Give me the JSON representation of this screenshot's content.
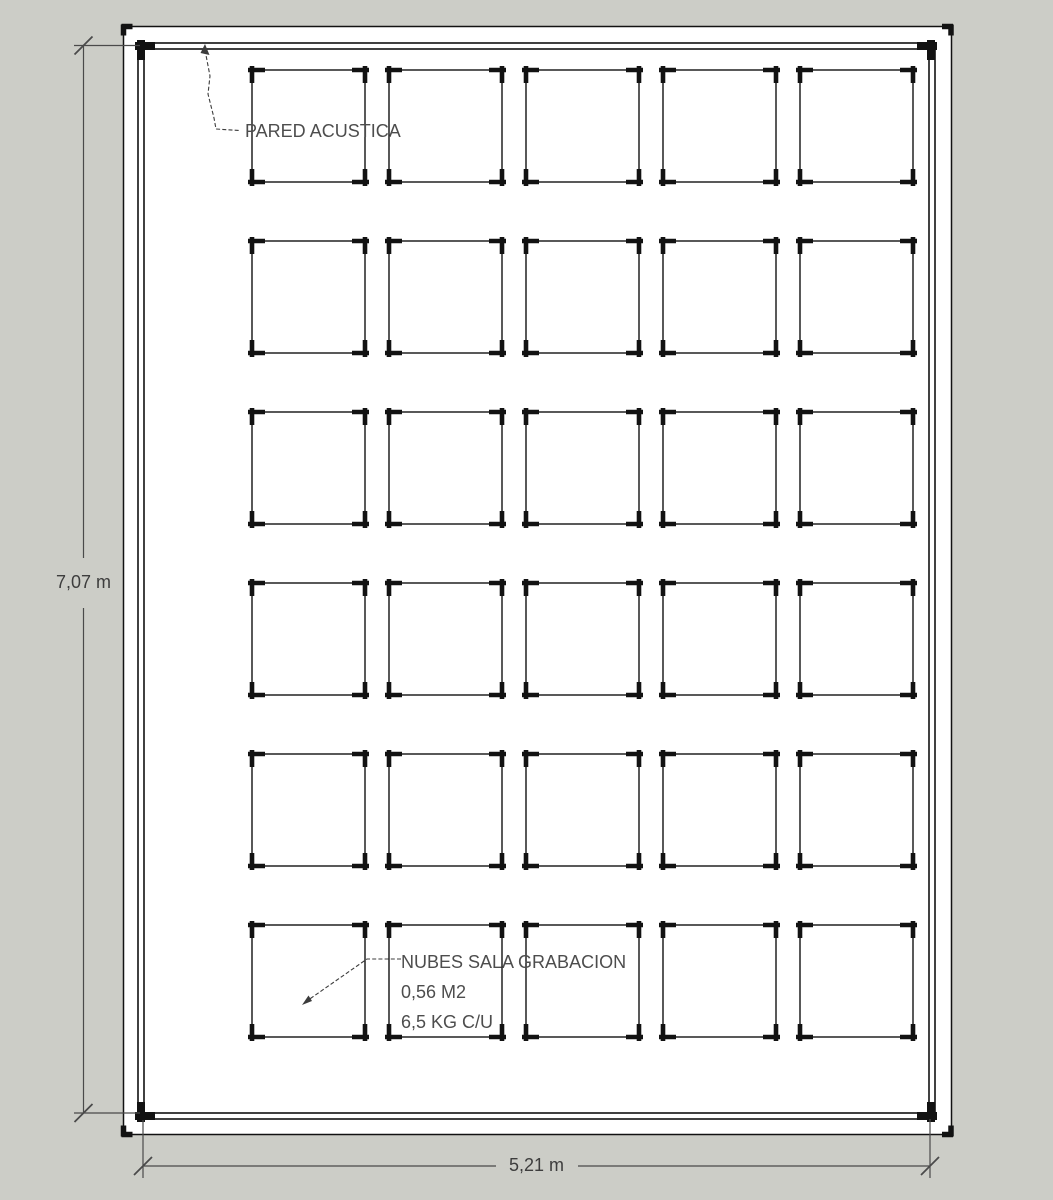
{
  "drawing": {
    "labels": {
      "wall": "PARED ACUSTICA",
      "clouds": [
        "NUBES SALA GRABACION",
        "0,56 M2",
        "6,5 KG C/U"
      ]
    },
    "dimensions": {
      "height": "7,07 m",
      "width": "5,21 m"
    },
    "grid": {
      "rows": 6,
      "columns": 5,
      "panel_count": 30
    },
    "colors": {
      "background": "#cccdc7",
      "paper": "#ffffff",
      "edge": "#121212",
      "annotation": "#4d4d4d",
      "dimension": "#3d3d3d"
    }
  }
}
